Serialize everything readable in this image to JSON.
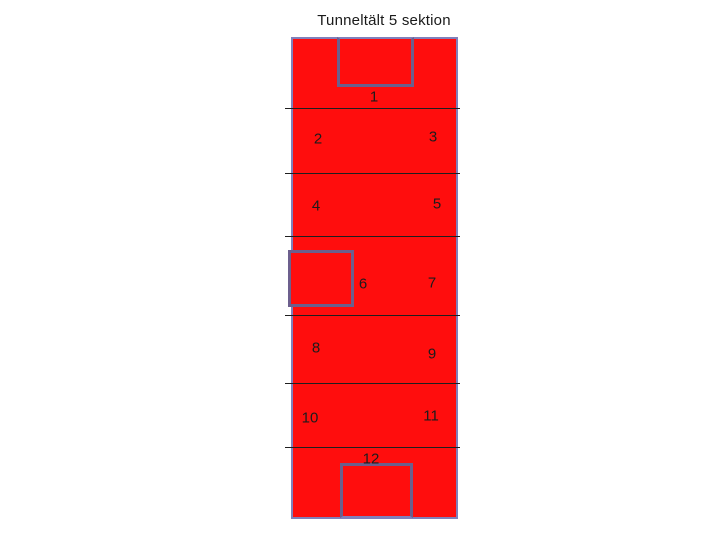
{
  "title": "Tunneltält 5 sektion",
  "section_labels": [
    "1",
    "2",
    "3",
    "4",
    "5",
    "6",
    "7",
    "8",
    "9",
    "10",
    "11",
    "12"
  ],
  "openings": {
    "top": "opening-top",
    "left": "opening-left",
    "bottom": "opening-bottom"
  },
  "colors": {
    "background": "#ffffff",
    "tent_fill": "#ff0d0d",
    "outer_border": "#8080bb",
    "opening_border": "#6c5f8d",
    "divider": "#1f1f1f",
    "label_text": "#1c1c1c"
  }
}
